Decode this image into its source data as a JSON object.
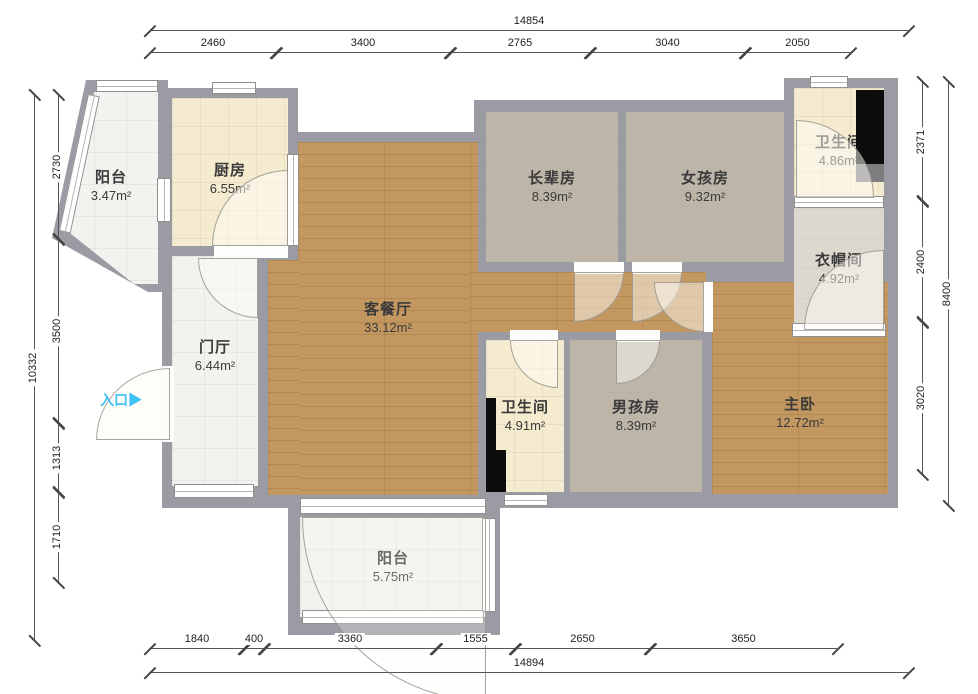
{
  "plan": {
    "entrance": {
      "label": "入口",
      "arrow": "▶"
    },
    "rooms": [
      {
        "id": "balcony-top",
        "name": "阳台",
        "area": "3.47m²"
      },
      {
        "id": "kitchen",
        "name": "厨房",
        "area": "6.55m²"
      },
      {
        "id": "elder-room",
        "name": "长辈房",
        "area": "8.39m²"
      },
      {
        "id": "girl-room",
        "name": "女孩房",
        "area": "9.32m²"
      },
      {
        "id": "bathroom-top",
        "name": "卫生间",
        "area": "4.86m²"
      },
      {
        "id": "cloakroom",
        "name": "衣帽间",
        "area": "4.92m²"
      },
      {
        "id": "foyer",
        "name": "门厅",
        "area": "6.44m²"
      },
      {
        "id": "living-dining",
        "name": "客餐厅",
        "area": "33.12m²"
      },
      {
        "id": "bathroom-mid",
        "name": "卫生间",
        "area": "4.91m²"
      },
      {
        "id": "boy-room",
        "name": "男孩房",
        "area": "8.39m²"
      },
      {
        "id": "master-bedroom",
        "name": "主卧",
        "area": "12.72m²"
      },
      {
        "id": "balcony-bottom",
        "name": "阳台",
        "area": "5.75m²"
      }
    ],
    "dimensions": {
      "top": {
        "total": "14854",
        "segments": [
          "2460",
          "3400",
          "2765",
          "3040",
          "2050"
        ]
      },
      "bottom": {
        "total": "14894",
        "segments": [
          "1840",
          "400",
          "3360",
          "1555",
          "2650",
          "3650"
        ]
      },
      "left": {
        "total": "10332",
        "segments": [
          "2730",
          "3500",
          "1313",
          "1710"
        ]
      },
      "right": {
        "total": "8400",
        "segments": [
          "2371",
          "2400",
          "3020"
        ]
      }
    },
    "colors": {
      "wall": "#9b9ca3",
      "wood_floor": "#c39760",
      "entrance_accent": "#3ec1f3"
    }
  }
}
